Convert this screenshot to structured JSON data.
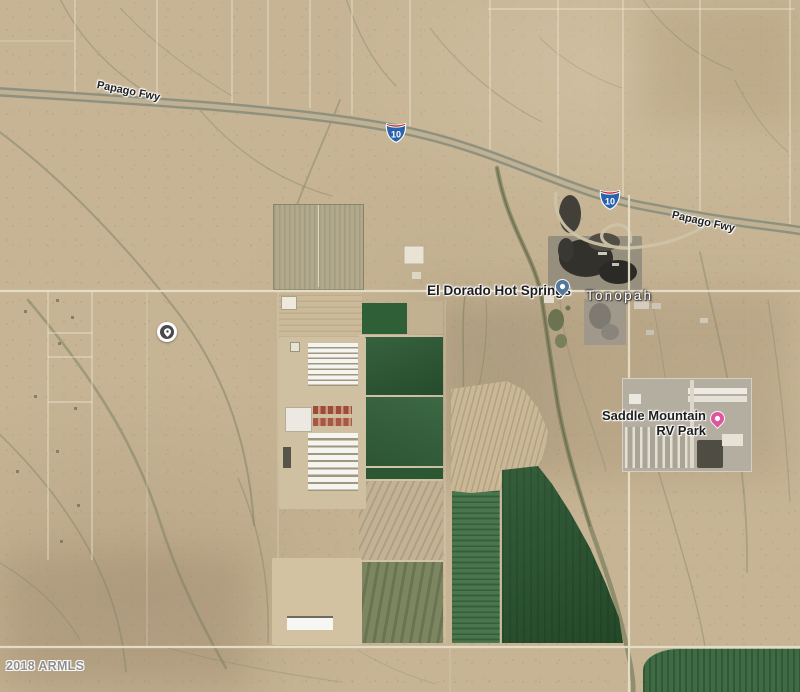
{
  "attribution": {
    "text": "2018 ARMLS"
  },
  "freeway": {
    "label_west": "Papago Fwy",
    "label_east": "Papago Fwy",
    "shield": "10"
  },
  "places": {
    "hot_springs": {
      "name": "El Dorado Hot Springs",
      "pin_color": "#54789b",
      "pin_icon": "poi-dot-pin"
    },
    "town": {
      "name": "Tonopah"
    },
    "rv_park": {
      "line1": "Saddle Mountain",
      "line2": "RV Park",
      "pin_color": "#de55a0",
      "pin_icon": "lodging-pin"
    }
  },
  "property_marker": {
    "icon": "location-pin-circle",
    "color": "#4a4a4a"
  },
  "colors": {
    "desert_base": "#c6b494",
    "field_green_dark": "#2d5a33",
    "field_green_strip": "#47724a",
    "field_olive": "#7c8660",
    "field_plowed_tan": "#c3b294",
    "shield_blue": "#2a63ad",
    "shield_red": "#bb2d30",
    "road_line": "#e6dfc8",
    "wash": "#7c8261",
    "town_label": "#ffffff",
    "poi_label": "#202020",
    "watermark": "#8f8f8f"
  }
}
